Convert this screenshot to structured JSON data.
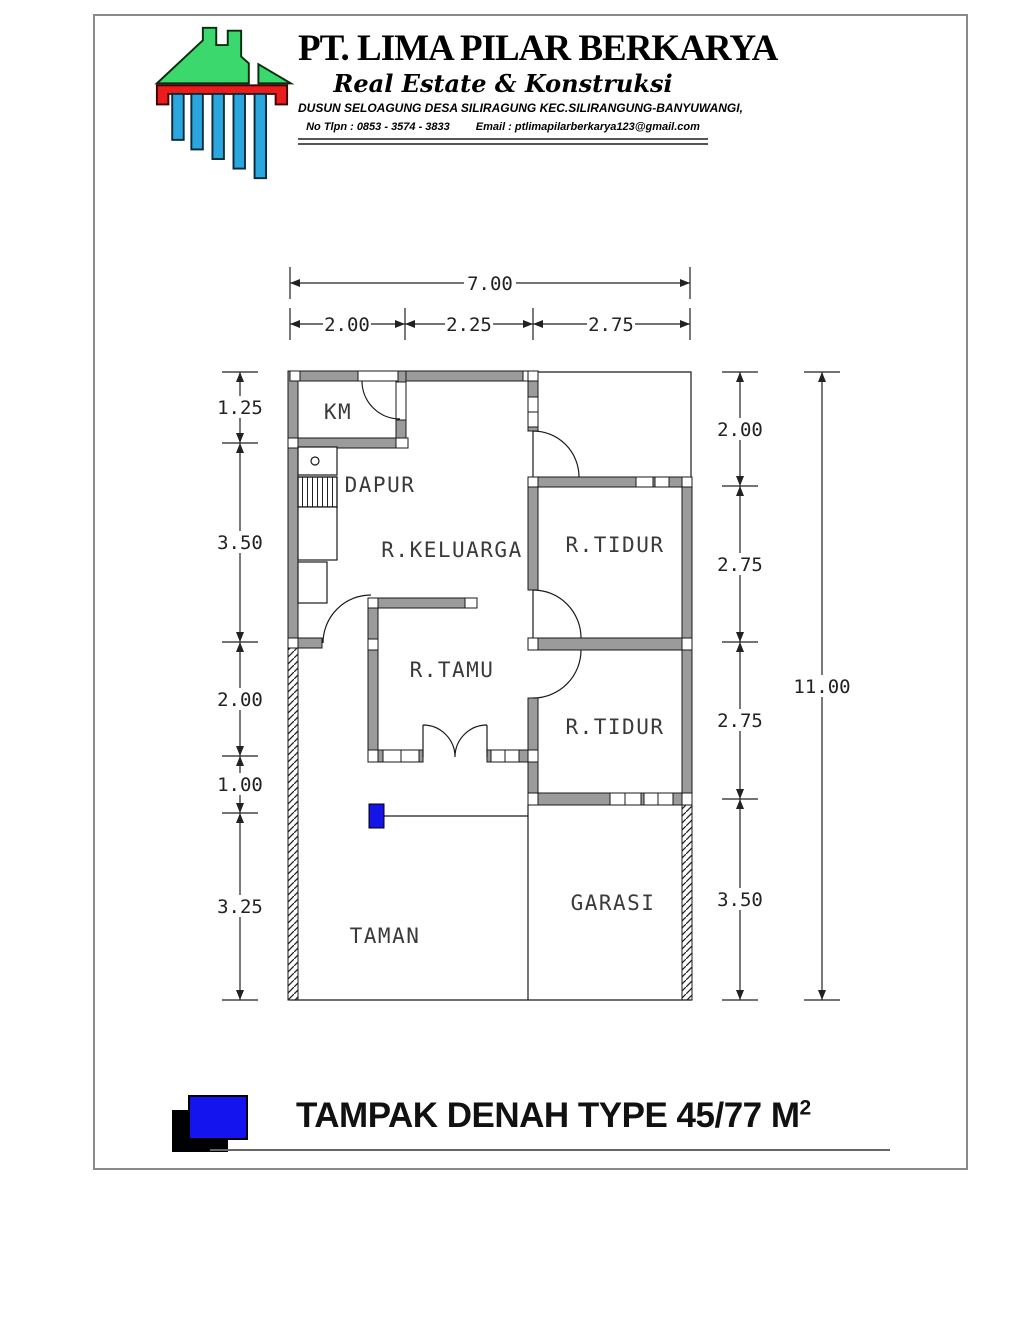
{
  "header": {
    "company_name": "PT. LIMA PILAR BERKARYA",
    "tagline": "Real Estate & Konstruksi",
    "address": "DUSUN SELOAGUNG DESA SILIRAGUNG KEC.SILIRANGUNG-BANYUWANGI,",
    "phone": "No Tlpn : 0853 - 3574 - 3833",
    "email": "Email : ptlimapilarberkarya123@gmail.com",
    "logo_colors": {
      "roof_green": "#3bd96d",
      "beam_red": "#ea1c1c",
      "pillar_blue": "#2aa7df"
    }
  },
  "plan": {
    "rooms": {
      "km": "KM",
      "dapur": "DAPUR",
      "keluarga": "R.KELUARGA",
      "tidur1": "R.TIDUR",
      "tamu": "R.TAMU",
      "tidur2": "R.TIDUR",
      "garasi": "GARASI",
      "taman": "TAMAN"
    },
    "dims": {
      "top_total": "7.00",
      "top": [
        "2.00",
        "2.25",
        "2.75"
      ],
      "left": [
        "1.25",
        "3.50",
        "2.00",
        "1.00",
        "3.25"
      ],
      "right": [
        "2.00",
        "2.75",
        "2.75",
        "3.50"
      ],
      "height_total": "11.00"
    },
    "colors": {
      "wall_gray": "#9b9b9b",
      "pillar_marker_blue": "#1414e6"
    }
  },
  "footer": {
    "title": "TAMPAK DENAH TYPE 45/77 M",
    "title_sup": "2"
  }
}
